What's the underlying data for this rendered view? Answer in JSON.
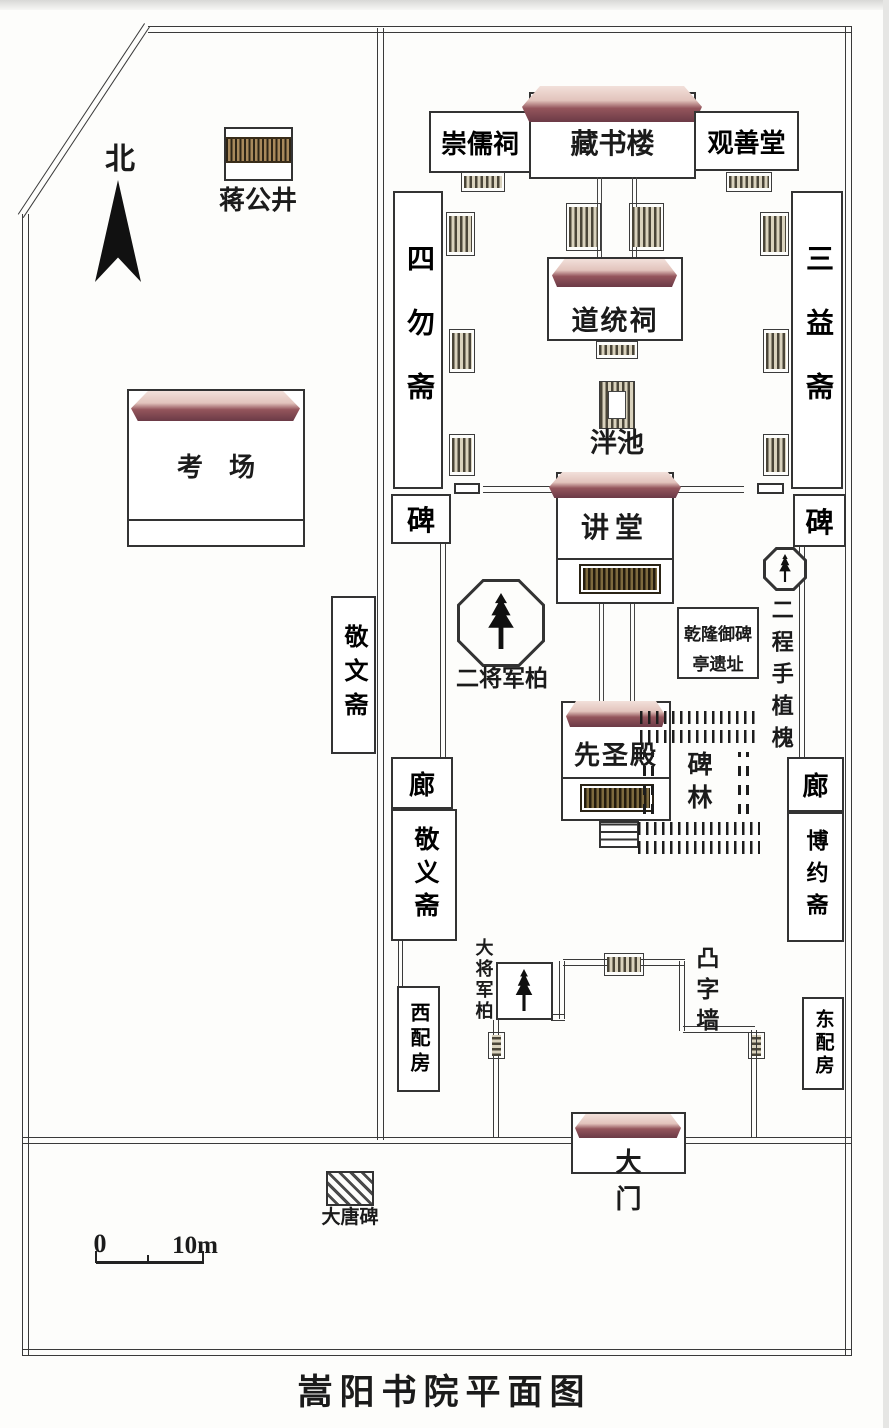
{
  "title": "嵩阳书院平面图",
  "compass": {
    "north": "北"
  },
  "scale": {
    "zero": "0",
    "ten": "10m"
  },
  "labels": {
    "jianggongjing": "蒋公井",
    "kaochang": "考场",
    "jingwenzhai": "敬文斋",
    "xipeifang": "西配房",
    "chongruci": "崇儒祠",
    "cangshulou": "藏书楼",
    "guanshantang": "观善堂",
    "siwuzhai": "四勿斋",
    "daotongci": "道统祠",
    "sanyizhai": "三益斋",
    "panchi": "泮池",
    "bei_left": "碑",
    "bei_right": "碑",
    "jiangtang": "讲堂",
    "erjiangjunbai": "二将军柏",
    "qianlong_l1": "乾隆御碑",
    "qianlong_l2": "亭遗址",
    "ercheng": "二程手植槐",
    "xianshengdian": "先圣殿",
    "beilin": "碑林",
    "lang_left": "廊",
    "lang_right": "廊",
    "jingyizhai": "敬义斋",
    "boyuezhai": "博约斋",
    "dajiangjunbai": "大将军柏",
    "tuziqiang": "凸字墙",
    "dongpeifang": "东配房",
    "damen": "大门",
    "datangbei": "大唐碑"
  },
  "colors": {
    "line": "#333333",
    "roof_dark": "#6b3a46",
    "roof_light": "#f2e0da",
    "steps_tan": "#d9d2bd",
    "steps_dark": "#4a4538",
    "background": "#fdfdfb"
  }
}
